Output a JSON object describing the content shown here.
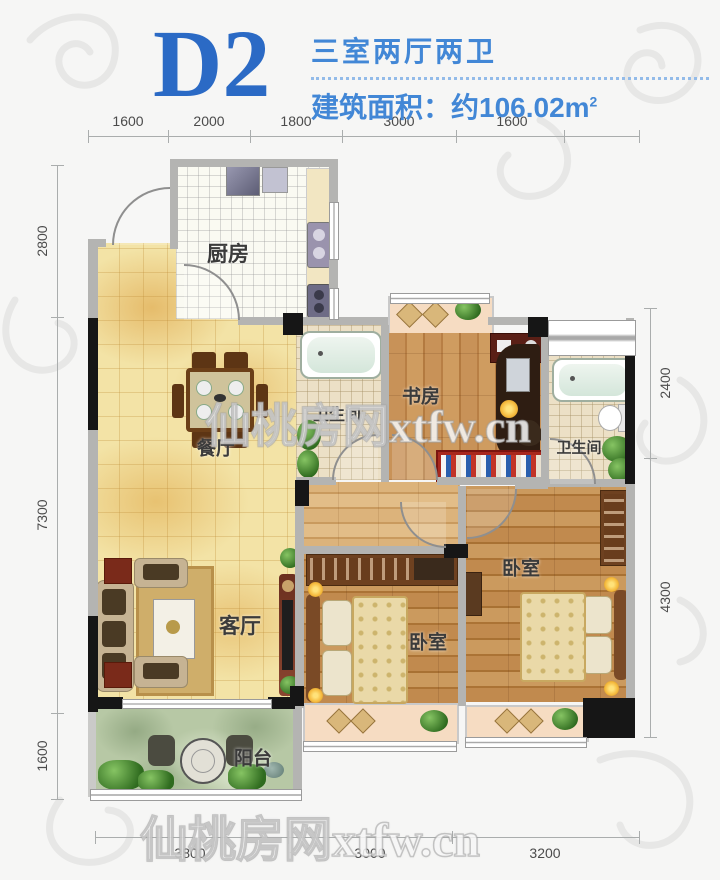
{
  "header": {
    "plan_code": "D2",
    "layout_type": "三室两厅两卫",
    "area_label": "建筑面积：约106.02m",
    "area_superscript": "2"
  },
  "watermarks": {
    "center": "仙桃房网xtfw.cn",
    "bottom": "仙桃房网xtfw.cn"
  },
  "dimensions": {
    "top": [
      "1600",
      "2000",
      "1800",
      "3000",
      "1600"
    ],
    "left": [
      "2800",
      "7300",
      "1600"
    ],
    "right": [
      "2400",
      "4300"
    ],
    "bottom": [
      "3800",
      "3000",
      "3200"
    ]
  },
  "rooms": {
    "kitchen": "厨房",
    "dining": "餐厅",
    "living": "客厅",
    "balcony": "阳台",
    "study": "书房",
    "bathroom1": "卫生间",
    "bathroom2": "卫生间",
    "bedroom_middle": "卧室",
    "bedroom_master": "卧室"
  },
  "colors": {
    "title_blue": "#2b6ac5",
    "accent_blue": "#4287d6",
    "wall_dark": "#161616",
    "wall_light": "#b4b4b2",
    "floor_tile_tan": "#f3e3a6",
    "floor_wood": "#c18a4e",
    "balcony_green": "#b7c8a5"
  }
}
